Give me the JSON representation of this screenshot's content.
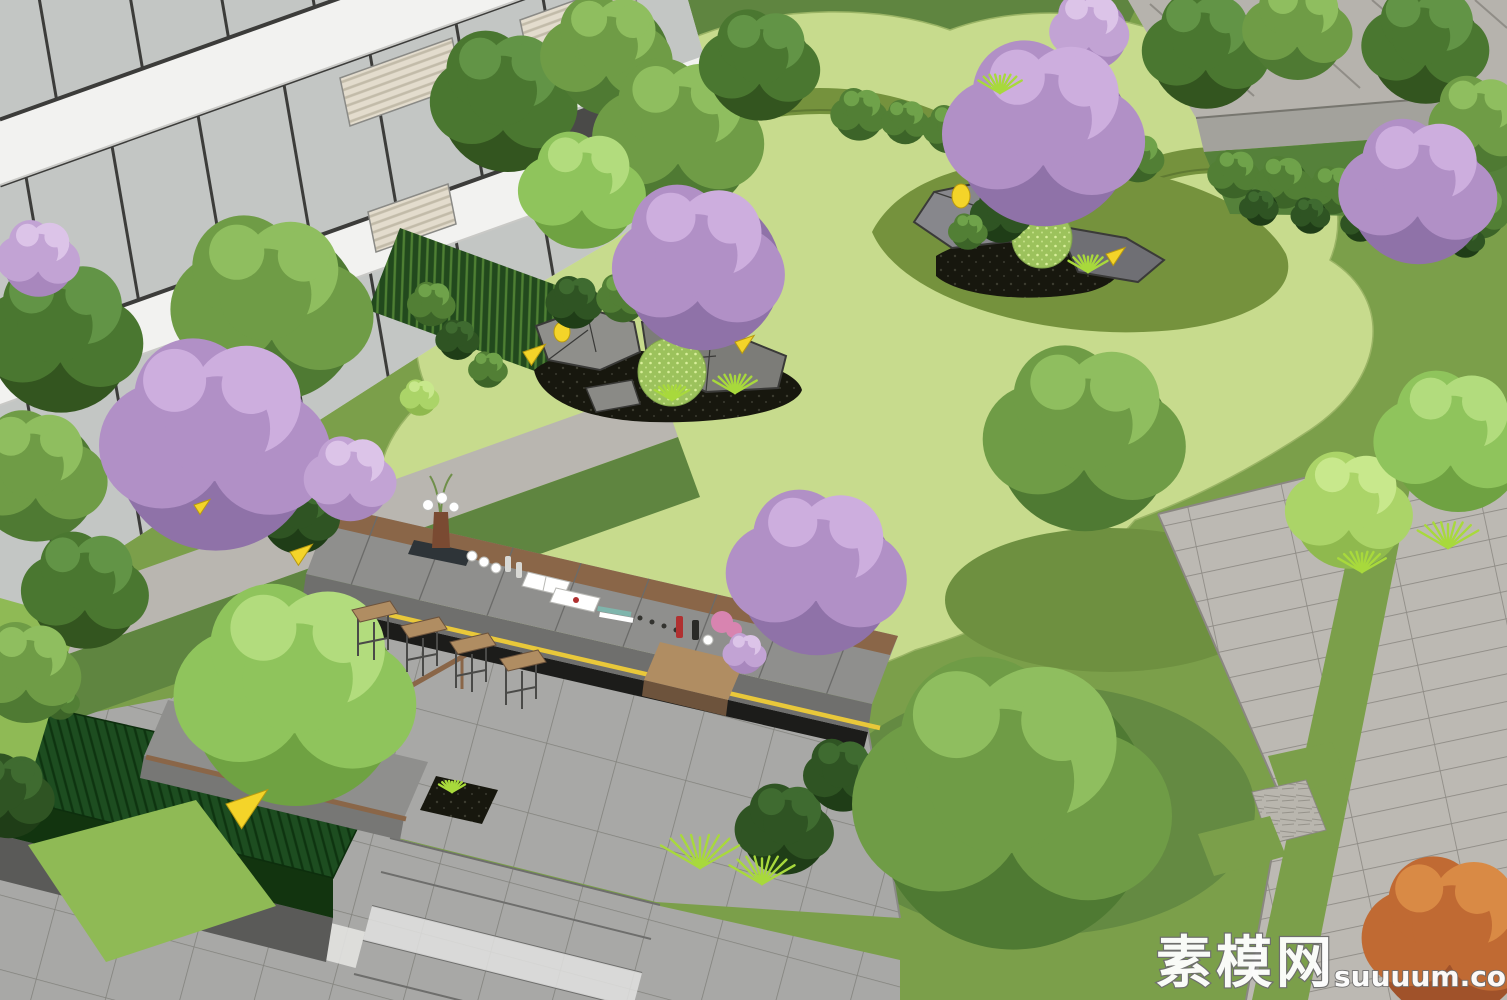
{
  "scene_title": "courtyard-landscape-3d-render",
  "watermark": {
    "cn": "素模网",
    "en": "suuuum.com"
  },
  "colors": {
    "bg_lawn": "#7b9f4a",
    "lawn_light": "#c7db8d",
    "lawn_dark": "#5f8540",
    "lawn_circle": "#6e9040",
    "lawn_shadow": "#648a42",
    "lawn_bright": "#8fba55",
    "lawn_olive": "#75923d",
    "shrub_under": "#55813a",
    "road": "#b6b3ad",
    "wall": "#a3a29c",
    "plaza": "#bcb9b3",
    "paving": "#a8a8a6",
    "paving_dark": "#8f8f8d",
    "paving_darker": "#6f6f6d",
    "paving_white": "#e2e2e0",
    "building_white": "#e9e9e7",
    "slab_white": "#f2f2f0",
    "frame_dark": "#3c3c3a",
    "glass": "#c3c6c4",
    "glass_dark": "#4a4a48",
    "awning": "#e3dccd",
    "awning_stripe": "#c2bba9",
    "bamboo_bg": "#22491d",
    "bamboo_stalk": "#4e7f33",
    "hedge": "#1d4d20",
    "hedge_line": "#0e3410",
    "stone_base": "#5a5a58",
    "wood": "#8a6648",
    "wood_light": "#b08d62",
    "wood_dark": "#6d533c",
    "rock": "#8f8f8b",
    "rock_dark": "#6f6f74",
    "rock_line": "#3a3a38",
    "mulch": "#17170e",
    "led": "#e9c83a",
    "accent_yellow": "#f4d429",
    "grass_blade": "#a8d93c",
    "speckle": "#d8ef9a",
    "table_tray": "#2e3438",
    "bottle_red": "#b03030",
    "flower_pink": "#d884b0"
  },
  "tree_palettes": {
    "green": {
      "dark": "#4f7a33",
      "base": "#6f9c46",
      "light": "#8fbe5f"
    },
    "green_dark": {
      "dark": "#33551f",
      "base": "#4a7730",
      "light": "#629446"
    },
    "green_light": {
      "dark": "#6fa242",
      "base": "#8fc45c",
      "light": "#b2dc7d"
    },
    "purple": {
      "dark": "#8f72a8",
      "base": "#b190c6",
      "light": "#cdaede"
    },
    "purple_light": {
      "dark": "#a887bd",
      "base": "#c2a3d4",
      "light": "#dcc4e8"
    },
    "lime": {
      "dark": "#8fb94e",
      "base": "#abd468",
      "light": "#c8e88c"
    },
    "orange": {
      "dark": "#a0522a",
      "base": "#c06a33",
      "light": "#d98a45"
    },
    "bush": {
      "dark": "#3c6428",
      "base": "#527f35",
      "light": "#6fa24a"
    },
    "bush_dark": {
      "dark": "#1f3d17",
      "base": "#2f5423",
      "light": "#3f6b30"
    }
  },
  "trees": [
    {
      "x": 505,
      "y": 95,
      "r": 70,
      "t": "green_dark"
    },
    {
      "x": 610,
      "y": 50,
      "r": 60,
      "t": "green"
    },
    {
      "x": 680,
      "y": 130,
      "r": 78,
      "t": "green"
    },
    {
      "x": 585,
      "y": 185,
      "r": 58,
      "t": "green_light"
    },
    {
      "x": 760,
      "y": 60,
      "r": 55,
      "t": "green_dark"
    },
    {
      "x": 1205,
      "y": 45,
      "r": 58,
      "t": "green_dark"
    },
    {
      "x": 1300,
      "y": 25,
      "r": 50,
      "t": "green"
    },
    {
      "x": 1425,
      "y": 40,
      "r": 58,
      "t": "green_dark"
    },
    {
      "x": 1480,
      "y": 120,
      "r": 48,
      "t": "green"
    },
    {
      "x": 1090,
      "y": 28,
      "r": 38,
      "t": "purple_light"
    },
    {
      "x": 1420,
      "y": 185,
      "r": 72,
      "t": "purple",
      "trunk": 1
    },
    {
      "x": 1045,
      "y": 125,
      "r": 92,
      "t": "purple",
      "trunk": 1
    },
    {
      "x": 60,
      "y": 330,
      "r": 75,
      "t": "green_dark"
    },
    {
      "x": 35,
      "y": 470,
      "r": 65,
      "t": "green"
    },
    {
      "x": 85,
      "y": 585,
      "r": 58,
      "t": "green_dark"
    },
    {
      "x": 28,
      "y": 668,
      "r": 50,
      "t": "green"
    },
    {
      "x": 40,
      "y": 255,
      "r": 38,
      "t": "purple_light"
    },
    {
      "x": 270,
      "y": 300,
      "r": 92,
      "t": "green"
    },
    {
      "x": 215,
      "y": 435,
      "r": 105,
      "t": "purple",
      "trunk": 1
    },
    {
      "x": 352,
      "y": 475,
      "r": 42,
      "t": "purple_light"
    },
    {
      "x": 700,
      "y": 260,
      "r": 82,
      "t": "purple",
      "trunk": 1
    },
    {
      "x": 1085,
      "y": 430,
      "r": 92,
      "t": "green",
      "trunk": 1
    },
    {
      "x": 1455,
      "y": 435,
      "r": 70,
      "t": "green_light"
    },
    {
      "x": 820,
      "y": 565,
      "r": 82,
      "t": "purple",
      "trunk": 1
    },
    {
      "x": 300,
      "y": 685,
      "r": 110,
      "t": "green_light",
      "trunk": 1
    },
    {
      "x": 1010,
      "y": 790,
      "r": 145,
      "t": "green",
      "trunk": 1
    },
    {
      "x": 1450,
      "y": 930,
      "r": 80,
      "t": "orange",
      "trunk": 1
    }
  ],
  "bushes": [
    {
      "x": 860,
      "y": 112,
      "r": 26,
      "t": "bush"
    },
    {
      "x": 905,
      "y": 120,
      "r": 22,
      "t": "bush"
    },
    {
      "x": 950,
      "y": 127,
      "r": 24,
      "t": "bush"
    },
    {
      "x": 998,
      "y": 134,
      "r": 22,
      "t": "bush"
    },
    {
      "x": 1046,
      "y": 141,
      "r": 24,
      "t": "bush"
    },
    {
      "x": 1092,
      "y": 149,
      "r": 22,
      "t": "bush"
    },
    {
      "x": 1138,
      "y": 156,
      "r": 24,
      "t": "bush"
    },
    {
      "x": 1235,
      "y": 172,
      "r": 24,
      "t": "bush"
    },
    {
      "x": 1283,
      "y": 180,
      "r": 26,
      "t": "bush"
    },
    {
      "x": 1332,
      "y": 188,
      "r": 24,
      "t": "bush"
    },
    {
      "x": 1382,
      "y": 195,
      "r": 26,
      "t": "bush"
    },
    {
      "x": 1432,
      "y": 202,
      "r": 24,
      "t": "bush"
    },
    {
      "x": 1482,
      "y": 210,
      "r": 26,
      "t": "bush"
    },
    {
      "x": 1260,
      "y": 206,
      "r": 18,
      "t": "bush_dark"
    },
    {
      "x": 1310,
      "y": 214,
      "r": 18,
      "t": "bush_dark"
    },
    {
      "x": 1360,
      "y": 222,
      "r": 18,
      "t": "bush_dark"
    },
    {
      "x": 1412,
      "y": 230,
      "r": 18,
      "t": "bush_dark"
    },
    {
      "x": 1465,
      "y": 238,
      "r": 18,
      "t": "bush_dark"
    },
    {
      "x": 575,
      "y": 300,
      "r": 26,
      "t": "bush_dark"
    },
    {
      "x": 622,
      "y": 296,
      "r": 24,
      "t": "bush"
    },
    {
      "x": 660,
      "y": 310,
      "r": 20,
      "t": "bush"
    },
    {
      "x": 1002,
      "y": 212,
      "r": 28,
      "t": "bush_dark"
    },
    {
      "x": 968,
      "y": 230,
      "r": 18,
      "t": "bush"
    },
    {
      "x": 432,
      "y": 302,
      "r": 22,
      "t": "bush"
    },
    {
      "x": 458,
      "y": 338,
      "r": 20,
      "t": "bush_dark"
    },
    {
      "x": 488,
      "y": 368,
      "r": 18,
      "t": "bush"
    },
    {
      "x": 420,
      "y": 396,
      "r": 18,
      "t": "lime"
    },
    {
      "x": 852,
      "y": 560,
      "r": 26,
      "t": "purple_light"
    },
    {
      "x": 745,
      "y": 652,
      "r": 20,
      "t": "purple_light"
    },
    {
      "x": 785,
      "y": 825,
      "r": 45,
      "t": "bush_dark"
    },
    {
      "x": 842,
      "y": 772,
      "r": 36,
      "t": "bush_dark"
    },
    {
      "x": 8,
      "y": 792,
      "r": 42,
      "t": "bush_dark"
    },
    {
      "x": 300,
      "y": 512,
      "r": 38,
      "t": "bush_dark"
    },
    {
      "x": 1352,
      "y": 505,
      "r": 58,
      "t": "lime"
    },
    {
      "x": 60,
      "y": 700,
      "r": 18,
      "t": "bush"
    }
  ],
  "grass_tufts": [
    {
      "x": 700,
      "y": 868,
      "s": 36
    },
    {
      "x": 762,
      "y": 884,
      "s": 30
    },
    {
      "x": 735,
      "y": 393,
      "s": 20
    },
    {
      "x": 1088,
      "y": 272,
      "s": 18
    },
    {
      "x": 1448,
      "y": 548,
      "s": 28
    },
    {
      "x": 1362,
      "y": 572,
      "s": 22
    },
    {
      "x": 1000,
      "y": 93,
      "s": 20
    },
    {
      "x": 672,
      "y": 400,
      "s": 16
    },
    {
      "x": 452,
      "y": 792,
      "s": 12
    }
  ],
  "spotlight_triangles": [
    {
      "x": 523,
      "y": 352,
      "s": 14
    },
    {
      "x": 735,
      "y": 342,
      "s": 12
    },
    {
      "x": 1106,
      "y": 254,
      "s": 12
    },
    {
      "x": 226,
      "y": 804,
      "s": 26
    },
    {
      "x": 290,
      "y": 552,
      "s": 14
    },
    {
      "x": 194,
      "y": 505,
      "s": 10
    }
  ],
  "bar_stools": [
    {
      "x": 372,
      "y": 610
    },
    {
      "x": 421,
      "y": 626
    },
    {
      "x": 470,
      "y": 642
    },
    {
      "x": 520,
      "y": 659
    }
  ]
}
